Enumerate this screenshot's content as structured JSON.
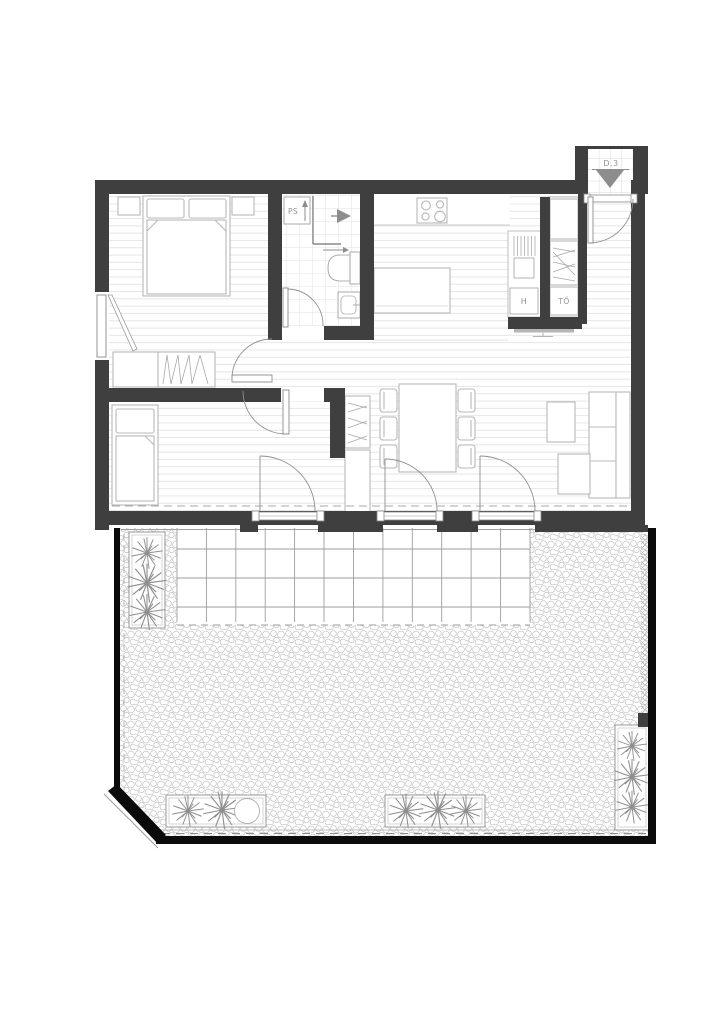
{
  "plan": {
    "unit_label": "D.3",
    "labels": {
      "pipe_shaft": "PS",
      "fridge": "H",
      "storage": "TŐ"
    },
    "colors": {
      "wall": "#3f3f3f",
      "terrace_edge": "#0b0b0b",
      "label_text": "#929292",
      "arrow_fill": "#8d8d8d",
      "floor_line": "#e2e2e2",
      "furniture_line": "#b8b8b8"
    }
  }
}
